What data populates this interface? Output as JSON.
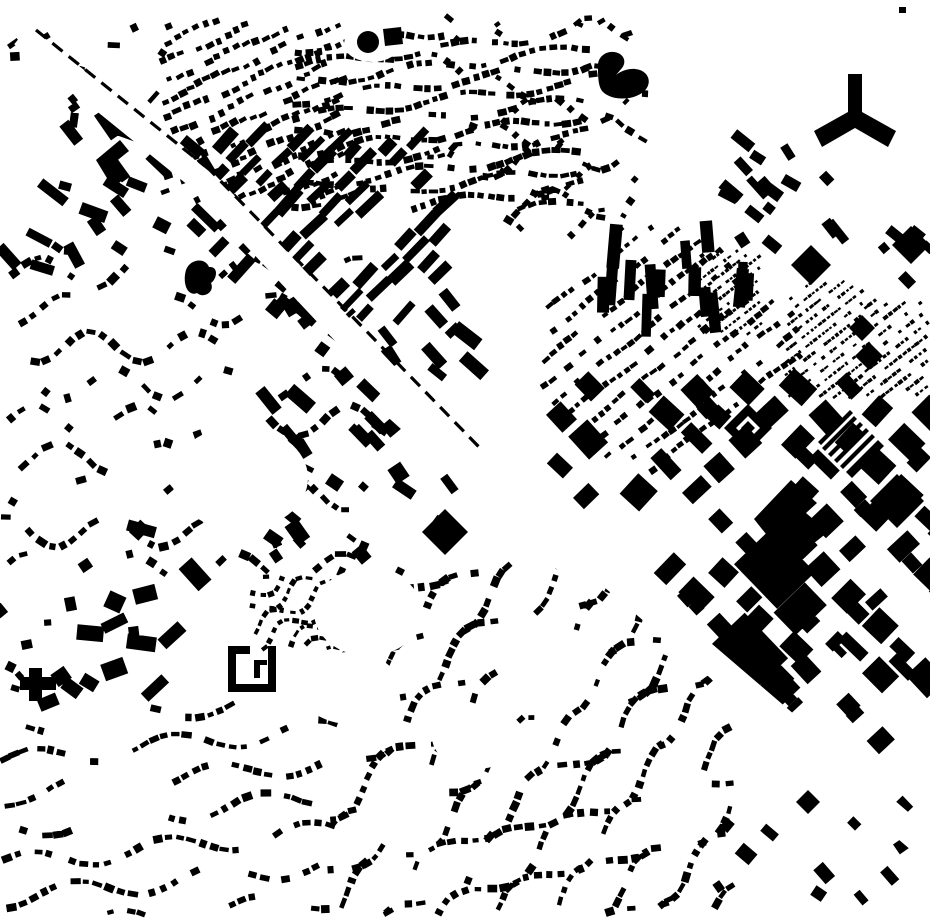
{
  "canvas": {
    "width": 930,
    "height": 924,
    "bg": "#ffffff",
    "ink": "#000000"
  },
  "seed": 1371,
  "clusters": [
    {
      "name": "north-rows-west",
      "type": "rows",
      "x0": 160,
      "y0": 18,
      "x1": 345,
      "y1": 205,
      "angle": -24,
      "rowSpacing": 17,
      "step": 10,
      "w": 7,
      "h": 5.5,
      "skip": 0.2,
      "curveAmp": 3,
      "curvePeriod": 90,
      "angleJitter": 14,
      "phaseLock": true
    },
    {
      "name": "north-rows-center",
      "type": "rows",
      "x0": 292,
      "y0": 30,
      "x1": 588,
      "y1": 212,
      "angle": -7,
      "rowSpacing": 17,
      "step": 10,
      "w": 7,
      "h": 5.5,
      "skip": 0.22,
      "curveAmp": 5,
      "curvePeriod": 130,
      "angleJitter": 14,
      "followCurve": true,
      "phaseLock": true
    },
    {
      "name": "ne-arc-rows",
      "type": "rows",
      "x0": 420,
      "y0": 14,
      "x1": 648,
      "y1": 238,
      "angle": -4,
      "rowSpacing": 24,
      "step": 11,
      "w": 7,
      "h": 5.5,
      "skip": 0.34,
      "curveAmp": 16,
      "curvePeriod": 110,
      "angleJitter": 16,
      "followCurve": true,
      "phaseLock": true,
      "pocketNoise": true
    },
    {
      "name": "ne-diagonal-cluster",
      "type": "scatter",
      "x0": 728,
      "y0": 140,
      "x1": 838,
      "y1": 262,
      "n": 17,
      "wMin": 9,
      "wMax": 26,
      "hMin": 7,
      "hMax": 12,
      "angle": 45,
      "angleJitter": 18
    },
    {
      "name": "mid-right-rows",
      "type": "rows",
      "x0": 538,
      "y0": 222,
      "x1": 802,
      "y1": 488,
      "angle": -38,
      "rowSpacing": 19,
      "step": 9.5,
      "w": 6.5,
      "h": 5,
      "skip": 0.24,
      "curveAmp": 2,
      "curvePeriod": 100,
      "angleJitter": 10,
      "clip": [
        [
          538,
          300
        ],
        [
          628,
          222
        ],
        [
          700,
          222
        ],
        [
          802,
          320
        ],
        [
          802,
          365
        ],
        [
          645,
          488
        ],
        [
          538,
          400
        ]
      ]
    },
    {
      "name": "tiny-dense-patch-1",
      "type": "rows",
      "x0": 697,
      "y0": 248,
      "x1": 764,
      "y1": 338,
      "angle": -38,
      "rowSpacing": 9,
      "step": 5,
      "w": 3.6,
      "h": 2.8,
      "skip": 0.26,
      "angleJitter": 8
    },
    {
      "name": "tiny-dense-patch-2",
      "type": "rows",
      "x0": 784,
      "y0": 280,
      "x1": 864,
      "y1": 400,
      "angle": -38,
      "rowSpacing": 9.5,
      "step": 5,
      "w": 3.6,
      "h": 2.8,
      "skip": 0.26,
      "angleJitter": 8
    },
    {
      "name": "vertical-slab-group",
      "type": "scatter",
      "x0": 596,
      "y0": 224,
      "x1": 748,
      "y1": 318,
      "n": 15,
      "wMin": 8,
      "wMax": 13,
      "hMin": 26,
      "hMax": 46,
      "angle": 0,
      "angleJitter": 6
    },
    {
      "name": "right-industrial-blocks",
      "type": "blocks",
      "x0": 558,
      "y0": 368,
      "x1": 935,
      "y1": 712,
      "angle": 45,
      "cell": 37,
      "fill": 0.78,
      "wMin": 14,
      "wMax": 32,
      "hMin": 12,
      "hMax": 30,
      "megaProb": 0.1,
      "lProb": 0.18,
      "clip": [
        [
          558,
          368
        ],
        [
          935,
          368
        ],
        [
          935,
          712
        ],
        [
          786,
          712
        ],
        [
          558,
          518
        ]
      ]
    },
    {
      "name": "se-commercial-blocks",
      "type": "blocks",
      "x0": 606,
      "y0": 592,
      "x1": 918,
      "y1": 838,
      "angle": 45,
      "cell": 33,
      "fill": 0.6,
      "fade": 0.75,
      "wMin": 10,
      "wMax": 28,
      "hMin": 9,
      "hMax": 22,
      "lProb": 0.22,
      "clip": [
        [
          651,
          592
        ],
        [
          918,
          592
        ],
        [
          918,
          821
        ]
      ]
    },
    {
      "name": "corridor-slab-rows",
      "type": "rows",
      "x0": 214,
      "y0": 132,
      "x1": 448,
      "y1": 318,
      "angle": 44,
      "rowSpacing": 27,
      "step": 17,
      "w": 9,
      "h": 24,
      "skip": 0.34,
      "angleJitter": 7
    },
    {
      "name": "center-mixed-commercial",
      "type": "scatter",
      "x0": 268,
      "y0": 298,
      "x1": 486,
      "y1": 562,
      "n": 46,
      "wMin": 8,
      "wMax": 30,
      "hMin": 7,
      "hMax": 16,
      "angle": 45,
      "angleJitter": 14
    },
    {
      "name": "small-arc-cluster",
      "type": "rows",
      "x0": 250,
      "y0": 570,
      "x1": 362,
      "y1": 652,
      "angle": -28,
      "rowSpacing": 15,
      "step": 8,
      "w": 5.5,
      "h": 4.2,
      "skip": 0.3,
      "curveAmp": 8,
      "curvePeriod": 60,
      "followCurve": true,
      "angleJitter": 12
    },
    {
      "name": "campus-cluster",
      "type": "scatter",
      "x0": 48,
      "y0": 528,
      "x1": 206,
      "y1": 706,
      "n": 18,
      "wMin": 10,
      "wMax": 30,
      "hMin": 8,
      "hMax": 18,
      "angle": 15,
      "angleJitter": 70
    },
    {
      "name": "left-curvilinear-suburb",
      "type": "rows",
      "x0": 0,
      "y0": 245,
      "x1": 372,
      "y1": 578,
      "angle": 0,
      "rowSpacing": 37,
      "step": 11,
      "w": 8.5,
      "h": 6.5,
      "skip": 0.32,
      "curveAmp": 15,
      "curvePeriod": 105,
      "followCurve": true,
      "phaseLock": true,
      "angleJitter": 16,
      "pocketNoise": true
    },
    {
      "name": "bottom-suburb",
      "type": "rows",
      "x0": 328,
      "y0": 562,
      "x1": 734,
      "y1": 916,
      "angle": -36,
      "rowSpacing": 26,
      "step": 10.5,
      "w": 8,
      "h": 6,
      "skip": 0.3,
      "curveAmp": 14,
      "curvePeriod": 130,
      "followCurve": true,
      "phaseLock": true,
      "angleJitter": 14,
      "pocketNoise": true,
      "clip": [
        [
          328,
          565
        ],
        [
          582,
          565
        ],
        [
          734,
          692
        ],
        [
          734,
          916
        ],
        [
          328,
          916
        ]
      ]
    },
    {
      "name": "bottom-left-wavy-rows",
      "type": "rows",
      "x0": 0,
      "y0": 702,
      "x1": 338,
      "y1": 916,
      "angle": -6,
      "rowSpacing": 34,
      "step": 10.5,
      "w": 8,
      "h": 6,
      "skip": 0.3,
      "curveAmp": 10,
      "curvePeriod": 140,
      "followCurve": true,
      "phaseLock": true,
      "angleJitter": 12,
      "pocketNoise": true
    },
    {
      "name": "nw-slab-cluster",
      "type": "scatter",
      "x0": 0,
      "y0": 116,
      "x1": 208,
      "y1": 268,
      "n": 24,
      "wMin": 12,
      "wMax": 34,
      "hMin": 8,
      "hMax": 13,
      "angle": 40,
      "angleJitter": 25
    },
    {
      "name": "nw-top-sparse",
      "type": "scatter",
      "x0": 4,
      "y0": 14,
      "x1": 168,
      "y1": 122,
      "n": 13,
      "wMin": 6,
      "wMax": 16,
      "hMin": 4,
      "hMax": 9,
      "angle": -40,
      "angleJitter": 45
    },
    {
      "name": "right-edge-blocks",
      "type": "scatter",
      "x0": 866,
      "y0": 214,
      "x1": 930,
      "y1": 292,
      "n": 5,
      "wMin": 9,
      "wMax": 20,
      "hMin": 7,
      "hMax": 14,
      "angle": 45,
      "angleJitter": 12
    },
    {
      "name": "right-edge-tiny-rows",
      "type": "rows",
      "x0": 862,
      "y0": 298,
      "x1": 930,
      "y1": 400,
      "angle": -38,
      "rowSpacing": 10,
      "step": 5.5,
      "w": 4,
      "h": 3,
      "skip": 0.3,
      "angleJitter": 8
    },
    {
      "name": "bottom-right-sparse",
      "type": "scatter",
      "x0": 686,
      "y0": 812,
      "x1": 908,
      "y1": 900,
      "n": 11,
      "wMin": 8,
      "wMax": 20,
      "hMin": 7,
      "hMax": 14,
      "angle": 45,
      "angleJitter": 12
    },
    {
      "name": "left-edge-sparse",
      "type": "scatter",
      "x0": 0,
      "y0": 556,
      "x1": 52,
      "y1": 706,
      "n": 6,
      "wMin": 7,
      "wMax": 14,
      "hMin": 6,
      "hMax": 10,
      "angle": 20,
      "angleJitter": 40
    }
  ],
  "roads": [
    {
      "name": "nw-corridor-upper",
      "from": [
        28,
        40
      ],
      "to": [
        208,
        186
      ],
      "width": 24
    },
    {
      "name": "nw-corridor-lower",
      "from": [
        202,
        180
      ],
      "to": [
        472,
        468
      ],
      "width": 26
    },
    {
      "name": "central-junction",
      "from": [
        398,
        386
      ],
      "to": [
        578,
        548
      ],
      "width": 60
    },
    {
      "name": "se-corridor",
      "from": [
        486,
        468
      ],
      "to": [
        948,
        864
      ],
      "width": 27
    }
  ],
  "pockets": [
    {
      "name": "pocket-west",
      "cx": 240,
      "cy": 478,
      "rx": 68,
      "ry": 52
    },
    {
      "name": "pocket-south-1",
      "cx": 368,
      "cy": 612,
      "rx": 54,
      "ry": 44
    },
    {
      "name": "pocket-south-2",
      "cx": 350,
      "cy": 688,
      "rx": 50,
      "ry": 36
    },
    {
      "name": "pocket-suburb",
      "cx": 476,
      "cy": 737,
      "rx": 44,
      "ry": 32
    },
    {
      "name": "pocket-dot-clearing",
      "cx": 372,
      "cy": 44,
      "rx": 28,
      "ry": 18
    }
  ],
  "railway": {
    "segments": [
      {
        "from": [
          36,
          30
        ],
        "to": [
          210,
          170
        ]
      },
      {
        "from": [
          206,
          166
        ],
        "to": [
          478,
          446
        ]
      }
    ],
    "dash": 13,
    "gap": 8,
    "width": 3.2
  },
  "landmarks": [
    {
      "name": "y-shaped-building",
      "d": "M848,74 L862,74 L862,112 L896,131 L888,147 L855,128 L822,147 L814,131 L848,112 Z"
    },
    {
      "name": "hook-shaped-building",
      "d": "M598,67 C597,56 608,49 618,53 C625,56 626,63 622,68 L616,75 C626,67 640,67 646,74 C651,80 649,88 642,93 C630,101 611,100 603,92 C598,87 598,76 598,67 Z"
    },
    {
      "name": "circular-building",
      "d": "M357,42 a11,11 0 1,0 22,0 a11,11 0 1,0 -22,0 Z"
    },
    {
      "name": "square-by-circle",
      "d": "M383,29 L401,27 L403,44 L385,46 Z"
    },
    {
      "name": "large-diamond-block",
      "d": "M811,245 L831,265 L811,285 L791,265 Z"
    },
    {
      "name": "diamond-block-b",
      "d": "M862,315 L875,328 L862,341 L849,328 Z"
    },
    {
      "name": "diamond-block-c",
      "d": "M869,342 L883,356 L869,370 L855,356 Z"
    },
    {
      "name": "diamond-block-ne",
      "d": "M911,226 L930,245 L911,264 L892,245 Z"
    },
    {
      "name": "diamond-block-s",
      "d": "M808,790 L820,802 L808,814 L796,802 Z"
    },
    {
      "name": "mega-notched-block",
      "d": "M754,519 L791,480 L817,503 L806,513 L828,532 L789,563 Z"
    },
    {
      "name": "block-with-courtyard-hole",
      "d": "M897,474 L924,501 L897,528 L870,501 Z M899,486 L907,494 L899,502 L891,494 Z"
    },
    {
      "name": "striped-bar-group",
      "d": "M818,442 L850,410 L853,413 L821,445 Z M822,448 L854,416 L857,419 L825,451 Z M828,454 L860,422 L863,425 L831,457 Z M834,460 L866,428 L869,431 L837,463 Z M840,466 L872,434 L875,437 L843,469 Z M846,472 L878,440 L884,446 L852,478 Z"
    },
    {
      "name": "nested-u-building",
      "d": "M748,404 L772,428 L748,452 L724,428 Z M748,416 L760,428 L748,440 L736,428 Z M748,421 L755,428 L748,435 L741,428 Z"
    },
    {
      "name": "courtyard-c-building",
      "d": "M228,646 L236,646 L236,684 L228,684 Z M268,646 L276,646 L276,684 L268,684 Z M228,684 L276,684 L276,692 L228,692 Z M236,646 L250,646 L250,654 L236,654 Z M254,660 L260,660 L260,678 L254,678 Z M260,660 L267,660 L267,665 L260,665 Z"
    },
    {
      "name": "cross-building",
      "d": "M20,677 L56,677 L56,690 L20,690 Z M29,668 L42,668 L42,677 L29,677 Z M29,690 L42,690 L42,701 L29,701 Z"
    },
    {
      "name": "irregular-blob-building",
      "d": "M186,270 C190,259 205,257 209,267 C219,266 217,279 211,283 C215,292 204,299 197,293 C188,297 182,284 186,270 Z"
    },
    {
      "name": "big-square-center",
      "d": "M445,509 L468,532 L445,555 L422,532 Z"
    },
    {
      "name": "nw-l-building",
      "d": "M96,160 L120,140 L129,151 L114,163 L126,177 L113,188 Z"
    },
    {
      "name": "top-dash-mark",
      "d": "M622,33 L631,30 L633,35 L624,38 Z"
    },
    {
      "name": "top-right-dot",
      "d": "M899,7 L906,7 L906,13 L899,13 Z"
    }
  ]
}
